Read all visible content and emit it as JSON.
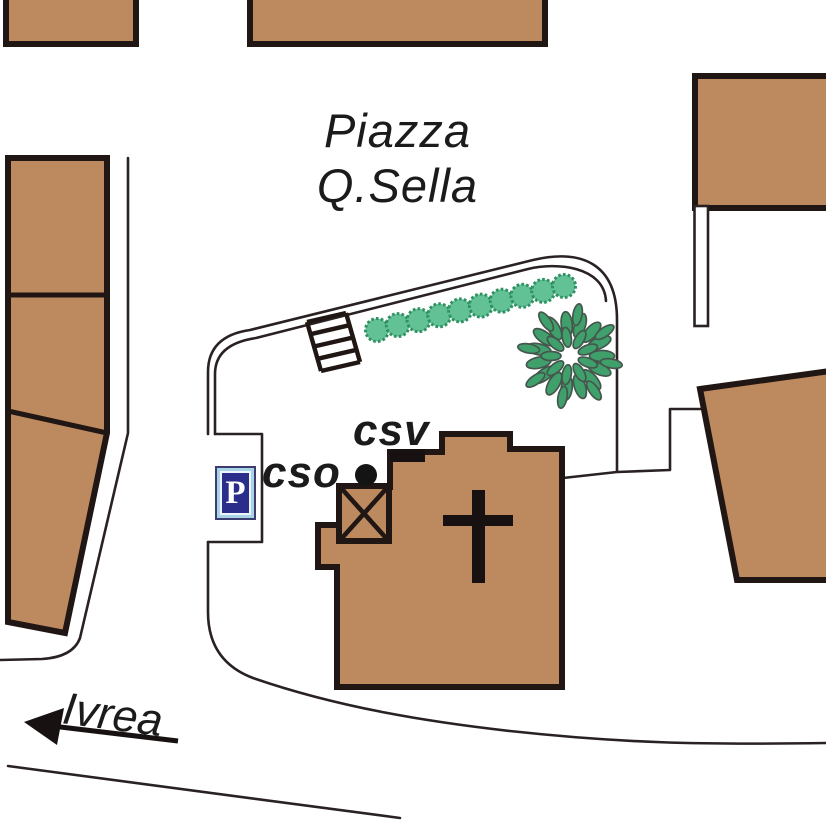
{
  "map": {
    "title": {
      "line1": "Piazza",
      "line2": "Q.Sella"
    },
    "labels": {
      "csv": "csv",
      "cso": "cso",
      "road_destination": "Ivrea"
    },
    "parking_sign": {
      "label": "P"
    },
    "icons": [
      "parking-icon",
      "cross-icon",
      "tree-icon",
      "shrub-icon",
      "stairs-icon",
      "direction-arrow-icon",
      "poi-dot-icon"
    ],
    "colors": {
      "building_fill": "#bd8a60",
      "outline_black": "#201613",
      "road_line": "#2a2222",
      "shrub_green": "#63c295",
      "tree_green": "#3fa06c",
      "parking_blue": "#2b2d8a",
      "parking_frame_blue": "#a9d3e6",
      "label_text": "#1b1b1b"
    },
    "greenery": {
      "shrub_row": {
        "count": 10,
        "from": [
          377,
          330
        ],
        "to": [
          564,
          286
        ],
        "radius": 11.5
      },
      "tree": {
        "center": [
          570,
          356
        ],
        "rings": [
          {
            "r": 32,
            "count": 15,
            "leaf": [
              12.5,
              5.5
            ],
            "offset": 0
          },
          {
            "r": 19,
            "count": 9,
            "leaf": [
              10,
              4.5
            ],
            "offset": 0.35
          },
          {
            "r": 42,
            "count": 8,
            "leaf": [
              11,
              4.5
            ],
            "offset": 0.18
          }
        ]
      }
    }
  }
}
